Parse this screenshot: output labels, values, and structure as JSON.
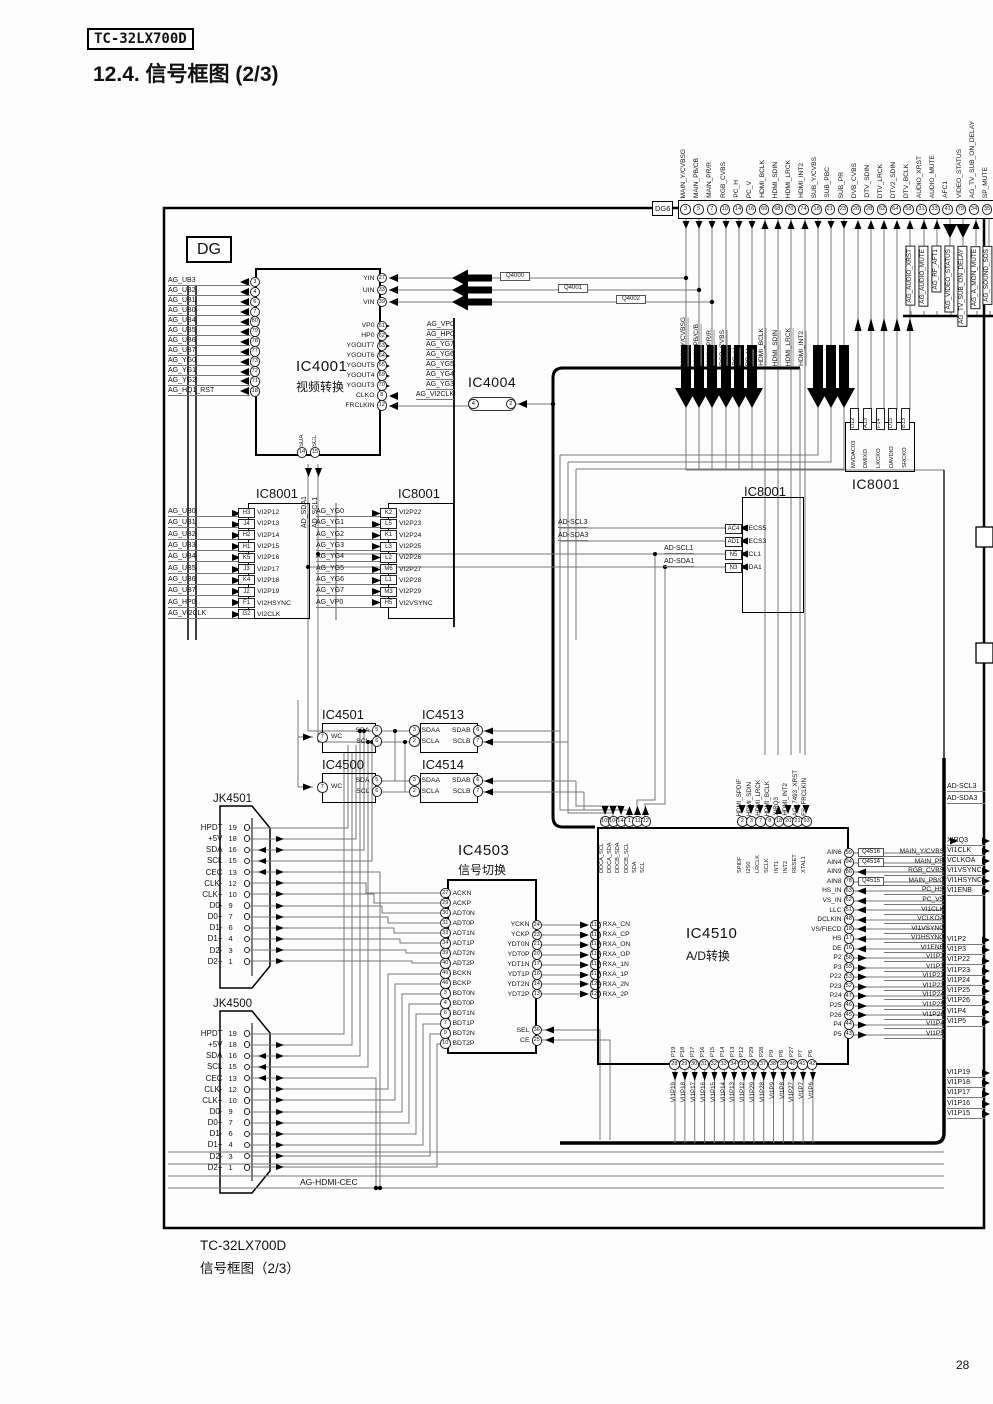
{
  "page": {
    "model_badge": "TC-32LX700D",
    "title": "12.4.  信号框图 (2/3)",
    "dg_label": "DG",
    "dg6_label": "DG6",
    "caption_model": "TC-32LX700D",
    "caption_title": "信号框图（2/3）",
    "page_number": "28",
    "ag_hdmi_cec": "AG-HDMI-CEC"
  },
  "dg6_pins": [
    {
      "n": "3",
      "t": "MAIN_Y/CVBSG"
    },
    {
      "n": "5",
      "t": "MAIN_PB/CB"
    },
    {
      "n": "7",
      "t": "MAIN_PR/R"
    },
    {
      "n": "10",
      "t": "RGB_CVBS"
    },
    {
      "n": "14",
      "t": "PC_H"
    },
    {
      "n": "16",
      "t": "PC_V"
    },
    {
      "n": "66",
      "t": "HDMI_BCLK"
    },
    {
      "n": "68",
      "t": "HDMI_SDIN"
    },
    {
      "n": "70",
      "t": "HDMI_LRCK"
    },
    {
      "n": "74",
      "t": "HDMI_INT2"
    },
    {
      "n": "18",
      "t": "SUB_Y/CVBS"
    },
    {
      "n": "21",
      "t": "SUB_PBC"
    },
    {
      "n": "23",
      "t": "SUB_PR"
    },
    {
      "n": "26",
      "t": "DVB_CVBS"
    },
    {
      "n": "28",
      "t": "DTV_SDIN"
    },
    {
      "n": "62",
      "t": "DTV_LRCK"
    },
    {
      "n": "64",
      "t": "DTV2_SDIN"
    },
    {
      "n": "58",
      "t": "DTV_BCLK"
    },
    {
      "n": "31",
      "t": "AUDIO_XRST"
    },
    {
      "n": "33",
      "t": "AUDIO_MUTE"
    },
    {
      "n": "41",
      "t": "AFC1"
    },
    {
      "n": "79",
      "t": "VIDEO_STATUS"
    },
    {
      "n": "34",
      "t": "AG_TV_SUB_ON_DELAY"
    },
    {
      "n": "35",
      "t": "SP_MUTE"
    }
  ],
  "dg6_sub_labels": [
    "MAIN_Y/CVBSG",
    "MAIN_PB/C/B",
    "MAIN_PR/R",
    "RGB_CVBS",
    "PC_H",
    "PC_V",
    "HDMI_BCLK",
    "HDMI_SDIN",
    "HDMI_LRCK",
    "HDMI_INT2"
  ],
  "ag_boxed_labels": [
    "AG_AUDIO_XRST",
    "AG_AUDIO_MUTE",
    "AG_RF_AFT1",
    "AG_VIDEO_STATUS",
    "AG_TV_SUB_ON_DELAY",
    "AG_A_MON_MUTE",
    "AG_SOUND_SOS"
  ],
  "q_boxes": [
    "Q4000",
    "Q4001",
    "Q4002"
  ],
  "ic4001": {
    "title": "IC4001",
    "subtitle": "视频转换",
    "left_pins": [
      {
        "s": "AG_UB3",
        "n": "3",
        "p": "VBOUT3"
      },
      {
        "s": "AG_UB2",
        "n": "4",
        "p": "VBOUT2"
      },
      {
        "s": "AG_UB1",
        "n": "6",
        "p": "VBOUT1"
      },
      {
        "s": "AG_UB0",
        "n": "7",
        "p": "VBOUT0"
      },
      {
        "s": "AG_UB4",
        "n": "80",
        "p": "VBOUT4"
      },
      {
        "s": "AG_UB5",
        "n": "79",
        "p": "VBOUT5"
      },
      {
        "s": "AG_UB6",
        "n": "78",
        "p": "VBOUT6"
      },
      {
        "s": "AG_UB7",
        "n": "77",
        "p": "VBOUT7"
      },
      {
        "s": "AG_YG0",
        "n": "73",
        "p": "YGOUT0"
      },
      {
        "s": "AG_YG1",
        "n": "72",
        "p": "YGOUT1"
      },
      {
        "s": "AG_YG2",
        "n": "71",
        "p": "YGOUT2"
      },
      {
        "s": "AG_HQ1_RST",
        "n": "18",
        "p": "NRST"
      }
    ],
    "top_right_pins": [
      {
        "p": "YIN",
        "n": "27"
      },
      {
        "p": "UIN",
        "n": "33"
      },
      {
        "p": "VIN",
        "n": "39"
      }
    ],
    "right_pins": [
      {
        "p": "VP0",
        "n": "61",
        "s": "AG_VP0"
      },
      {
        "p": "HP0",
        "n": "62",
        "s": "AG_HP0"
      },
      {
        "p": "YGOUT7",
        "n": "63",
        "s": "AG_YG7"
      },
      {
        "p": "YGOUT6",
        "n": "64",
        "s": "AG_YG6"
      },
      {
        "p": "YGOUT5",
        "n": "65",
        "s": "AG_YG5"
      },
      {
        "p": "YGOUT4",
        "n": "69",
        "s": "AG_YG4"
      },
      {
        "p": "YGOUT3",
        "n": "70",
        "s": "AG_YG3"
      },
      {
        "p": "CLKO",
        "n": "8",
        "s": "AG_VI2CLK"
      },
      {
        "p": "FRCLKIN",
        "n": "12",
        "s": ""
      }
    ],
    "bottom_pins": [
      {
        "p": "SDA",
        "n": "14"
      },
      {
        "p": "SCL",
        "n": "15"
      }
    ]
  },
  "ic4004": {
    "title": "IC4004",
    "pins": [
      "4",
      "2"
    ]
  },
  "ic8001_a": {
    "title": "IC8001",
    "bus_labels": [
      "AD_SDA1",
      "AD_SCL1"
    ],
    "pins": [
      {
        "s": "AG_UB0",
        "pb": "H3",
        "p": "VI2P12"
      },
      {
        "s": "AG_UB1",
        "pb": "J4",
        "p": "VI2P13"
      },
      {
        "s": "AG_UB2",
        "pb": "H2",
        "p": "VI2P14"
      },
      {
        "s": "AG_UB3",
        "pb": "H1",
        "p": "VI2P15"
      },
      {
        "s": "AG_UB4",
        "pb": "K5",
        "p": "VI2P16"
      },
      {
        "s": "AG_UB5",
        "pb": "J3",
        "p": "VI2P17"
      },
      {
        "s": "AG_UB6",
        "pb": "K4",
        "p": "VI2P18"
      },
      {
        "s": "AG_UB7",
        "pb": "J2",
        "p": "VI2P19"
      },
      {
        "s": "AG_HP0",
        "pb": "F1",
        "p": "VI2HSYNC"
      },
      {
        "s": "AG_VI2CLK",
        "pb": "G2",
        "p": "VI2CLK"
      }
    ]
  },
  "ic8001_b": {
    "title": "IC8001",
    "pins": [
      {
        "s": "AG_YG0",
        "pb": "K2",
        "p": "VI2P22"
      },
      {
        "s": "AG_YG1",
        "pb": "L5",
        "p": "VI2P23"
      },
      {
        "s": "AG_YG2",
        "pb": "K1",
        "p": "VI2P24"
      },
      {
        "s": "AG_YG3",
        "pb": "L3",
        "p": "VI2P25"
      },
      {
        "s": "AG_YG4",
        "pb": "L2",
        "p": "VI2P26"
      },
      {
        "s": "AG_YG5",
        "pb": "M6",
        "p": "VI2P27"
      },
      {
        "s": "AG_YG6",
        "pb": "L1",
        "p": "VI2P28"
      },
      {
        "s": "AG_YG7",
        "pb": "M3",
        "p": "VI2P29"
      },
      {
        "s": "AG_VP0",
        "pb": "H5",
        "p": "VI2VSYNC"
      }
    ]
  },
  "ic8001_c": {
    "title": "IC8001",
    "pins": [
      {
        "s": "AD-SCL3",
        "pb": "AC4",
        "p": "XECS5"
      },
      {
        "s": "AD-SDA3",
        "pb": "AD1",
        "p": "XECS3"
      },
      {
        "s": "AD-SCL1",
        "pb": "N5",
        "p": "SCL1"
      },
      {
        "s": "AD-SDA1",
        "pb": "N3",
        "p": "SDA1"
      }
    ]
  },
  "ic8001_d": {
    "title": "IC8001",
    "pins": [
      {
        "pb": "D12",
        "p": "MVDAC03"
      },
      {
        "pb": "A13",
        "p": "DMIXO"
      },
      {
        "pb": "F14",
        "p": "LKCKO"
      },
      {
        "pb": "D15",
        "p": "DAVDIO"
      },
      {
        "pb": "B13",
        "p": "SRCKO"
      }
    ]
  },
  "ic4501": {
    "title": "IC4501",
    "wc_pin": {
      "p": "WC",
      "n": "7"
    },
    "right": [
      {
        "p": "SDA",
        "n": "5"
      },
      {
        "p": "SCL",
        "n": "6"
      }
    ]
  },
  "ic4500": {
    "title": "IC4500",
    "wc_pin": {
      "p": "WC",
      "n": "7"
    },
    "right": [
      {
        "p": "SDA",
        "n": "5"
      },
      {
        "p": "SCL",
        "n": "6"
      }
    ]
  },
  "ic4513": {
    "title": "IC4513",
    "left": [
      {
        "p": "SDAA",
        "n": "3"
      },
      {
        "p": "SCLA",
        "n": "2"
      }
    ],
    "right": [
      {
        "p": "SDAB",
        "n": "6"
      },
      {
        "p": "SCLB",
        "n": "7"
      }
    ]
  },
  "ic4514": {
    "title": "IC4514",
    "left": [
      {
        "p": "SDAA",
        "n": "3"
      },
      {
        "p": "SCLA",
        "n": "2"
      }
    ],
    "right": [
      {
        "p": "SDAB",
        "n": "6"
      },
      {
        "p": "SCLB",
        "n": "7"
      }
    ]
  },
  "jk4501": {
    "title": "JK4501"
  },
  "jk4500": {
    "title": "JK4500"
  },
  "jk_pins": [
    {
      "s": "HPDT",
      "n": "19"
    },
    {
      "s": "+5V",
      "n": "18"
    },
    {
      "s": "SDA",
      "n": "16"
    },
    {
      "s": "SCL",
      "n": "15"
    },
    {
      "s": "CEC",
      "n": "13"
    },
    {
      "s": "CLK-",
      "n": "12"
    },
    {
      "s": "CLK+",
      "n": "10"
    },
    {
      "s": "D0-",
      "n": "9"
    },
    {
      "s": "D0+",
      "n": "7"
    },
    {
      "s": "D1-",
      "n": "6"
    },
    {
      "s": "D1+",
      "n": "4"
    },
    {
      "s": "D2-",
      "n": "3"
    },
    {
      "s": "D2+",
      "n": "1"
    }
  ],
  "ic4503": {
    "title": "IC4503",
    "subtitle": "信号切换",
    "left_pins": [
      {
        "n": "27",
        "p": "ACKN"
      },
      {
        "n": "29",
        "p": "ACKP"
      },
      {
        "n": "30",
        "p": "ADT0N"
      },
      {
        "n": "31",
        "p": "ADT0P"
      },
      {
        "n": "33",
        "p": "ADT1N"
      },
      {
        "n": "34",
        "p": "ADT1P"
      },
      {
        "n": "39",
        "p": "ADT2N"
      },
      {
        "n": "40",
        "p": "ADT2P"
      },
      {
        "n": "45",
        "p": "BCKN"
      },
      {
        "n": "46",
        "p": "BCKP"
      },
      {
        "n": "3",
        "p": "BDT0N"
      },
      {
        "n": "4",
        "p": "BDT0P"
      },
      {
        "n": "6",
        "p": "BDT1N"
      },
      {
        "n": "7",
        "p": "BDT1P"
      },
      {
        "n": "9",
        "p": "BDT2N"
      },
      {
        "n": "10",
        "p": "BDT2P"
      }
    ],
    "right_pins": [
      {
        "p": "YCKN",
        "n": "24"
      },
      {
        "p": "YCKP",
        "n": "23"
      },
      {
        "p": "YDT0N",
        "n": "21"
      },
      {
        "p": "YDT0P",
        "n": "20"
      },
      {
        "p": "YDT1N",
        "n": "17"
      },
      {
        "p": "YDT1P",
        "n": "16"
      },
      {
        "p": "YDT2N",
        "n": "14"
      },
      {
        "p": "YDT2P",
        "n": "13"
      }
    ],
    "ctl_pins": [
      {
        "p": "SEL",
        "n": "36"
      },
      {
        "p": "CE",
        "n": "25"
      }
    ]
  },
  "rxa_pins": [
    {
      "n": "112",
      "p": "RXA_CN"
    },
    {
      "n": "113",
      "p": "RXA_CP"
    },
    {
      "n": "115",
      "p": "RXA_ON"
    },
    {
      "n": "116",
      "p": "RXA_OP"
    },
    {
      "n": "118",
      "p": "RXA_1N"
    },
    {
      "n": "119",
      "p": "RXA_1P"
    },
    {
      "n": "121",
      "p": "RXA_2N"
    },
    {
      "n": "122",
      "p": "RXA_2P"
    }
  ],
  "ic4510": {
    "title": "IC4510",
    "subtitle": "A/D转换",
    "top_pins_a": [
      {
        "n": "105",
        "p": "DDCA_SCL"
      },
      {
        "n": "106",
        "p": "DDCA_SDA"
      },
      {
        "n": "144",
        "p": "DDCB_SDA"
      },
      {
        "n": "1",
        "p": "DDCB_SCL"
      },
      {
        "n": "11",
        "p": "SDA"
      },
      {
        "n": "12",
        "p": "SCL"
      }
    ],
    "top_pins_b": [
      {
        "n": "2",
        "p": "SPIDF"
      },
      {
        "n": "3",
        "p": "I2S0"
      },
      {
        "n": "7",
        "p": "LRCLK"
      },
      {
        "n": "8",
        "p": "SCLK"
      },
      {
        "n": "18",
        "p": "INT1"
      },
      {
        "n": "20",
        "p": "INT2"
      },
      {
        "n": "21",
        "p": "RESET"
      },
      {
        "n": "93",
        "p": "XTAL1"
      }
    ],
    "top_labels_b": [
      "HDMI_SPDIF",
      "HDMI_SDIN",
      "HDMI_LRCK",
      "HDMI_BCLK",
      "XIRQ3",
      "HDMI_INT2",
      "AG_7493_XRST",
      "FS_FRCLKIN"
    ],
    "right_pins": [
      {
        "p": "AIN6",
        "n": "99",
        "q": "Q4516",
        "s": "MAIN_Y/CVBS"
      },
      {
        "p": "AIN4",
        "n": "94",
        "q": "Q4514",
        "s": "MAIN_PR"
      },
      {
        "p": "AIN9",
        "n": "86",
        "q": "",
        "s": "RGB_CVBS"
      },
      {
        "p": "AIN8",
        "n": "78",
        "q": "Q4515",
        "s": "MAIN_PB/C"
      },
      {
        "p": "HS_IN",
        "n": "63",
        "q": "",
        "s": "PC_HS"
      },
      {
        "p": "VS_IN",
        "n": "62",
        "q": "",
        "s": "PC_VS"
      },
      {
        "p": "LLC",
        "n": "51",
        "q": "",
        "s": "VI1CLK"
      },
      {
        "p": "DCLKIN",
        "n": "48",
        "q": "",
        "s": "VCLKOA"
      },
      {
        "p": "VS/FIECD",
        "n": "18",
        "q": "",
        "s": "VI1VSYNC"
      },
      {
        "p": "HS",
        "n": "17",
        "q": "",
        "s": "VI1HSYNC"
      },
      {
        "p": "DE",
        "n": "16",
        "q": "",
        "s": "VI1ENB"
      },
      {
        "p": "P2",
        "n": "58",
        "q": "",
        "s": "VI1P2"
      },
      {
        "p": "P3",
        "n": "55",
        "q": "",
        "s": "VI1P3"
      },
      {
        "p": "P22",
        "n": "53",
        "q": "",
        "s": "VI1P22"
      },
      {
        "p": "P23",
        "n": "52",
        "q": "",
        "s": "VI1P23"
      },
      {
        "p": "P24",
        "n": "47",
        "q": "",
        "s": "VI1P24"
      },
      {
        "p": "P25",
        "n": "46",
        "q": "",
        "s": "VI1P25"
      },
      {
        "p": "P26",
        "n": "45",
        "q": "",
        "s": "VI1P26"
      },
      {
        "p": "P4",
        "n": "44",
        "q": "",
        "s": "VI1P4"
      },
      {
        "p": "P5",
        "n": "43",
        "q": "",
        "s": "VI1P5"
      }
    ],
    "bottom_pins": [
      {
        "p": "P19",
        "n": "28",
        "s": "VI1P19"
      },
      {
        "p": "P18",
        "n": "29",
        "s": "VI1P18"
      },
      {
        "p": "P17",
        "n": "30",
        "s": "VI1P17"
      },
      {
        "p": "P16",
        "n": "31",
        "s": "VI1P16"
      },
      {
        "p": "P15",
        "n": "32",
        "s": "VI1P15"
      },
      {
        "p": "P14",
        "n": "33",
        "s": "VI1P14"
      },
      {
        "p": "P13",
        "n": "34",
        "s": "VI1P13"
      },
      {
        "p": "P12",
        "n": "35",
        "s": "VI1P12"
      },
      {
        "p": "P29",
        "n": "36",
        "s": "VI1P29"
      },
      {
        "p": "P28",
        "n": "37",
        "s": "VI1P28"
      },
      {
        "p": "P9",
        "n": "38",
        "s": "VI1P9"
      },
      {
        "p": "P8",
        "n": "39",
        "s": "VI1P8"
      },
      {
        "p": "P27",
        "n": "40",
        "s": "VI1P27"
      },
      {
        "p": "P7",
        "n": "41",
        "s": "VI1P7"
      },
      {
        "p": "P6",
        "n": "42",
        "s": "VI1P6"
      }
    ]
  },
  "right_edge": {
    "top": [
      "AD-SCL3",
      "AD-SDA3"
    ],
    "mid": [
      "XIRQ3",
      "VI1CLK",
      "VCLKOA",
      "VI1VSYNC",
      "VI1HSYNC",
      "VI1ENB"
    ],
    "p_group": [
      "VI1P2",
      "VI1P3",
      "VI1P22",
      "VI1P23",
      "VI1P24",
      "VI1P25",
      "VI1P26",
      "VI1P4",
      "VI1P5"
    ],
    "bottom": [
      "VI1P19",
      "VI1P18",
      "VI1P17",
      "VI1P16",
      "VI1P15"
    ]
  }
}
